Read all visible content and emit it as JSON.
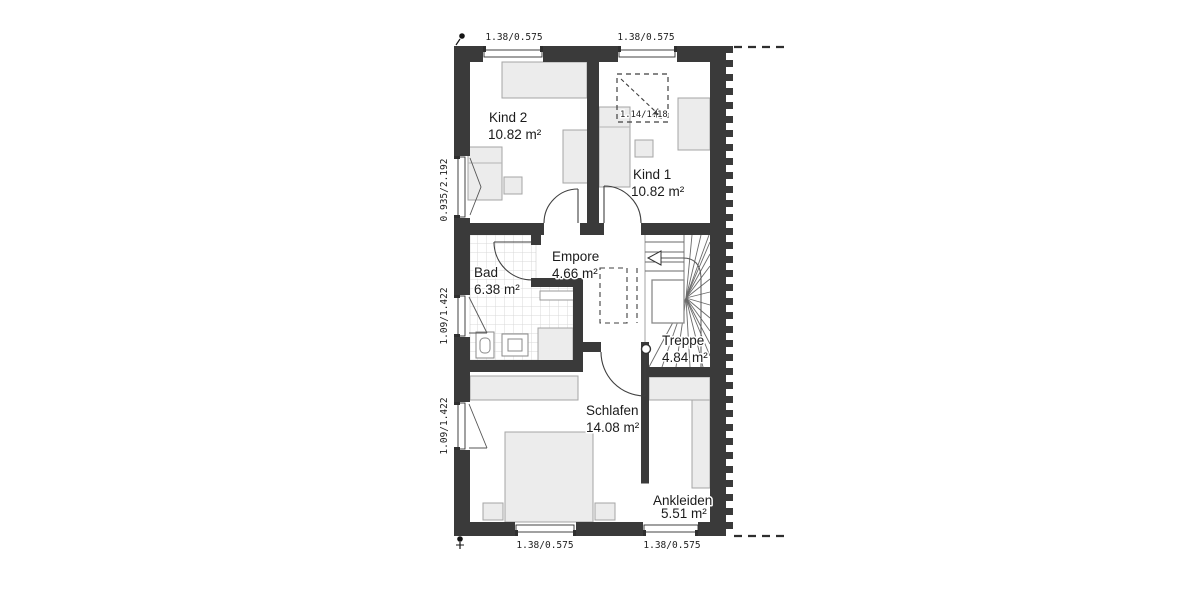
{
  "plan": {
    "type": "floor-plan",
    "floor": "upper-floor",
    "rooms": {
      "kind2": {
        "name": "Kind 2",
        "area": "10.82 m²"
      },
      "kind1": {
        "name": "Kind 1",
        "area": "10.82 m²"
      },
      "bad": {
        "name": "Bad",
        "area": "6.38 m²"
      },
      "empore": {
        "name": "Empore",
        "area": "4.66 m²"
      },
      "treppe": {
        "name": "Treppe",
        "area": "4.84 m²"
      },
      "schlafen": {
        "name": "Schlafen",
        "area": "14.08 m²"
      },
      "ankleiden": {
        "name": "Ankleiden",
        "area": "5.51 m²"
      }
    },
    "dimensions": {
      "top_left_window": "1.38/0.575",
      "top_right_window": "1.38/0.575",
      "bottom_left_window": "1.38/0.575",
      "bottom_right_window": "1.38/0.575",
      "left_upper_window": "0.935/2.192",
      "left_middle_window": "1.09/1.422",
      "left_lower_window": "1.09/1.422",
      "skylight": "1.14/1.18"
    },
    "colors": {
      "wall": "#3a3a3a",
      "furniture_fill": "#ececec",
      "furniture_stroke": "#a5a5a5",
      "tile_line": "#d8d8d8",
      "text": "#1b1b1b"
    }
  }
}
